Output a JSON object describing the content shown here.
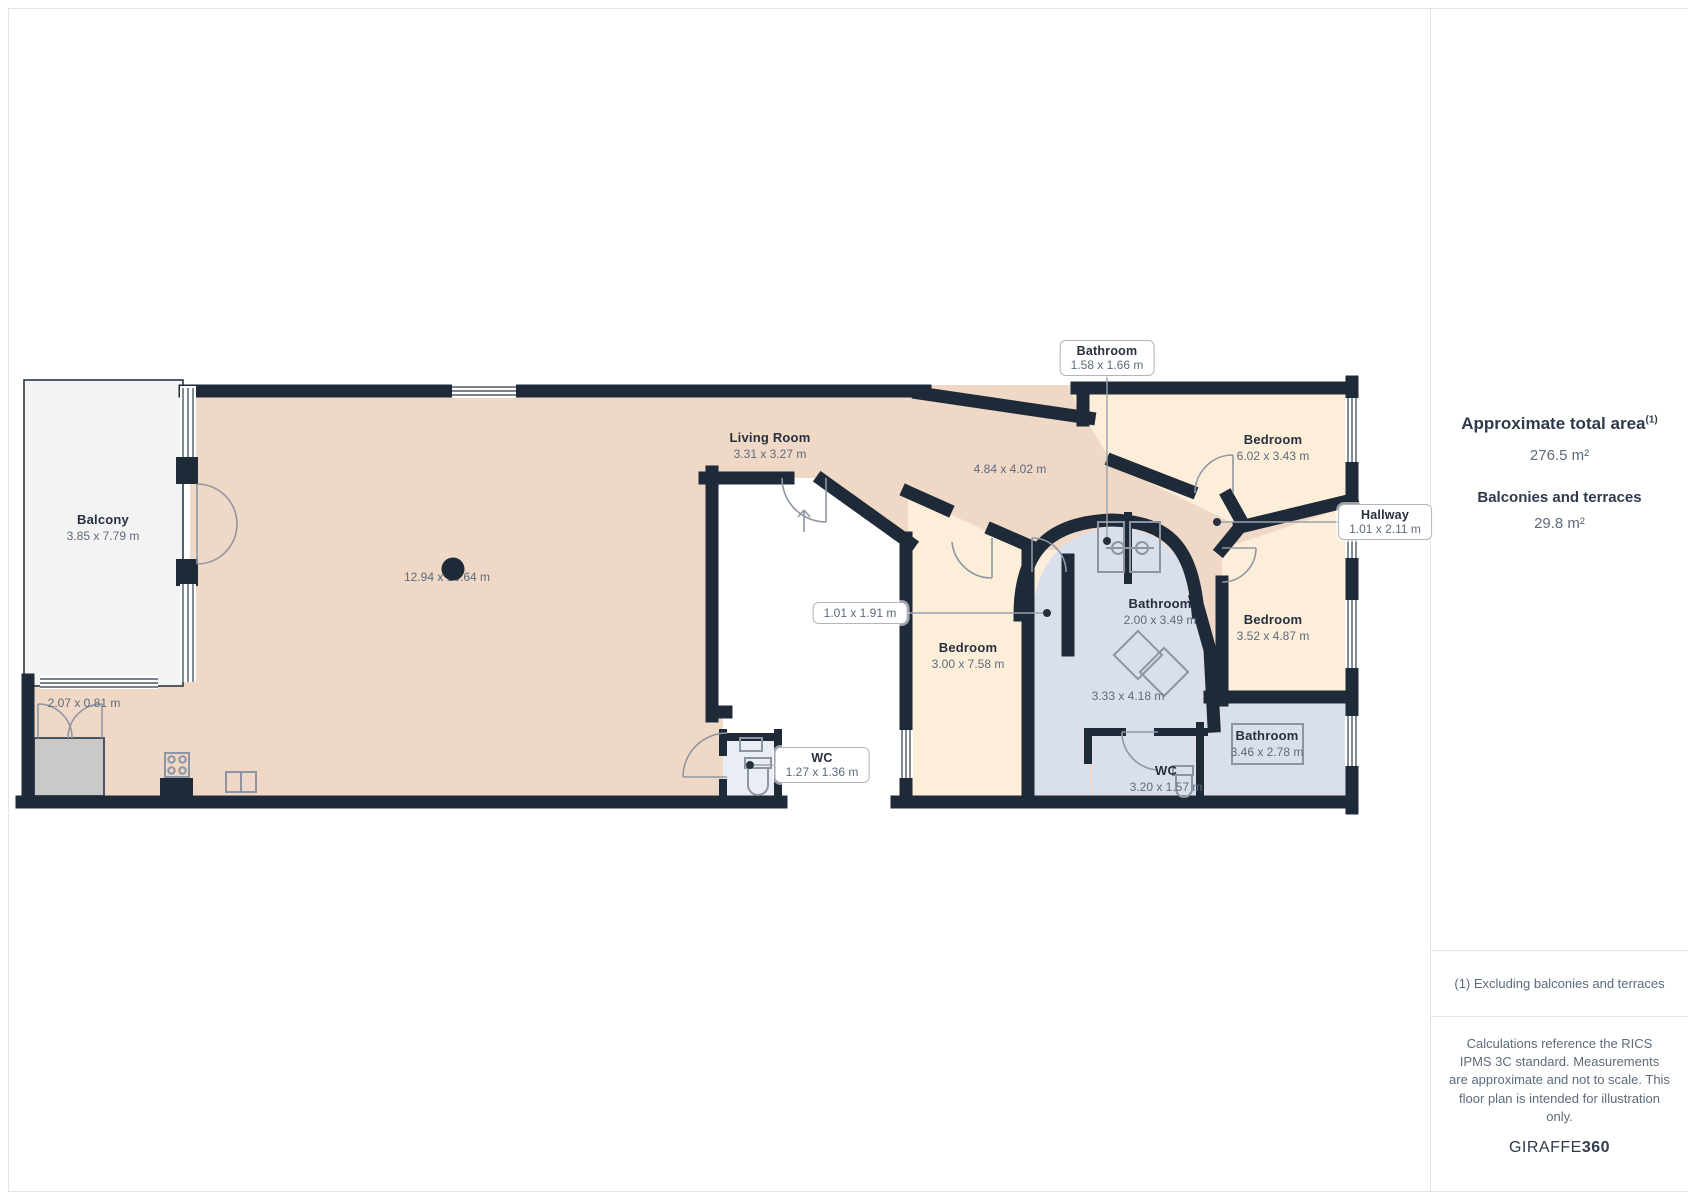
{
  "sidebar": {
    "total_area": {
      "title": "Approximate total area",
      "footnote_marker": "(1)",
      "value": "276.5 m²"
    },
    "balconies": {
      "title": "Balconies and terraces",
      "value": "29.8 m²"
    },
    "footnote": "(1) Excluding balconies and terraces",
    "disclaimer": "Calculations reference the RICS IPMS 3C standard. Measurements are approximate and not to scale. This floor plan is intended for illustration only.",
    "brand": {
      "name": "GIRAFFE",
      "suffix": "360"
    }
  },
  "floorplan": {
    "rooms": {
      "balcony": {
        "name": "Balcony",
        "dims": "3.85 x 7.79 m"
      },
      "living_room": {
        "name": "Living Room",
        "dims": "3.31 x 3.27 m"
      },
      "bedroom_top": {
        "name": "Bedroom",
        "dims": "6.02 x 3.43 m"
      },
      "bedroom_mid": {
        "name": "Bedroom",
        "dims": "3.00 x 7.58 m"
      },
      "bedroom_right": {
        "name": "Bedroom",
        "dims": "3.52 x 4.87 m"
      },
      "bathroom_mid": {
        "name": "Bathroom",
        "dims": "2.00 x 3.49 m"
      },
      "bathroom_right": {
        "name": "Bathroom",
        "dims": "3.46 x 2.78 m"
      },
      "wc_right": {
        "name": "WC",
        "dims": "3.20 x 1.57 m"
      }
    },
    "callouts": {
      "bathroom_top": {
        "name": "Bathroom",
        "dims": "1.58 x 1.66 m"
      },
      "hallway": {
        "name": "Hallway",
        "dims": "1.01 x 2.11 m"
      },
      "wc_mid": {
        "name": "WC",
        "dims": "1.27 x 1.36 m"
      },
      "niche": {
        "dims": "1.01 x 1.91 m"
      }
    },
    "dimensions": {
      "overall": "12.94 x 10.64 m",
      "open_area": "4.84 x 4.02 m",
      "closet": "2.07 x 0.81 m",
      "utility": "3.33 x 4.18 m"
    }
  },
  "colors": {
    "wall": "#1f2a38",
    "room_pink": "#f0d8c6",
    "room_cream": "#fdeeda",
    "room_blue": "#d9e0ec",
    "room_wc": "#e9edf5",
    "balcony": "#f3f3f3",
    "closet": "#c9c9c9"
  }
}
